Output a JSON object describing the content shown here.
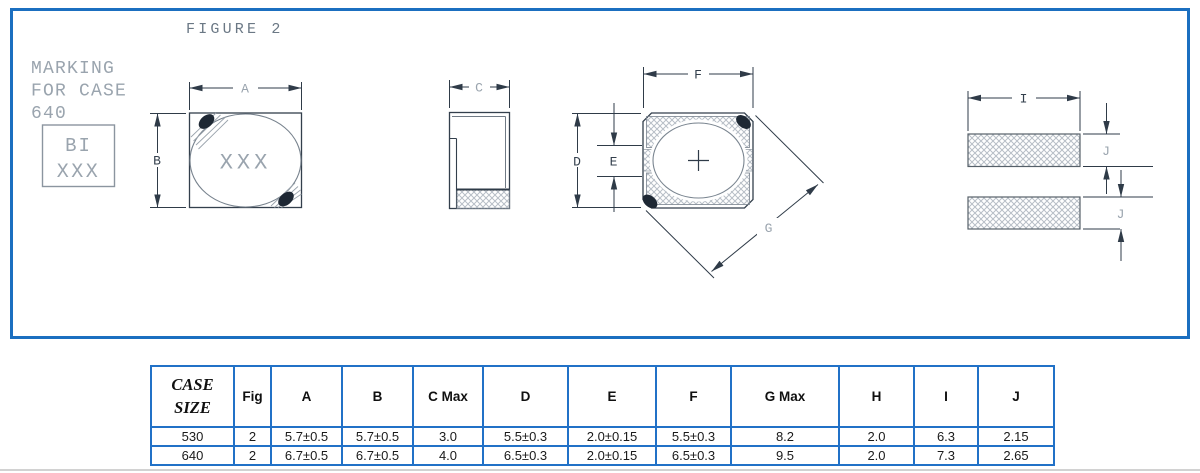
{
  "colors": {
    "frame_blue": "#1b6fc0",
    "table_border_blue": "#2171c7",
    "line_dark": "#2f3b48",
    "line_mid": "#707a85",
    "label_light": "#9aa4ae",
    "label_dark": "#333f4c",
    "blob_dark": "#1e2834",
    "hatch_gray": "#b7bec6"
  },
  "figure": {
    "title": "FIGURE 2",
    "marking_note_line1": "MARKING",
    "marking_note_line2": "FOR CASE",
    "marking_note_line3": "640",
    "marking_box_line1": "BI",
    "marking_box_line2": "XXX",
    "part_marking": "XXX",
    "dims": {
      "A": "A",
      "B": "B",
      "C": "C",
      "D": "D",
      "E": "E",
      "F": "F",
      "G": "G",
      "I": "I",
      "J": "J"
    }
  },
  "table": {
    "headers": [
      "CASE SIZE",
      "Fig",
      "A",
      "B",
      "C Max",
      "D",
      "E",
      "F",
      "G Max",
      "H",
      "I",
      "J"
    ],
    "rows": [
      [
        "530",
        "2",
        "5.7±0.5",
        "5.7±0.5",
        "3.0",
        "5.5±0.3",
        "2.0±0.15",
        "5.5±0.3",
        "8.2",
        "2.0",
        "6.3",
        "2.15"
      ],
      [
        "640",
        "2",
        "6.7±0.5",
        "6.7±0.5",
        "4.0",
        "6.5±0.3",
        "2.0±0.15",
        "6.5±0.3",
        "9.5",
        "2.0",
        "7.3",
        "2.65"
      ]
    ]
  }
}
